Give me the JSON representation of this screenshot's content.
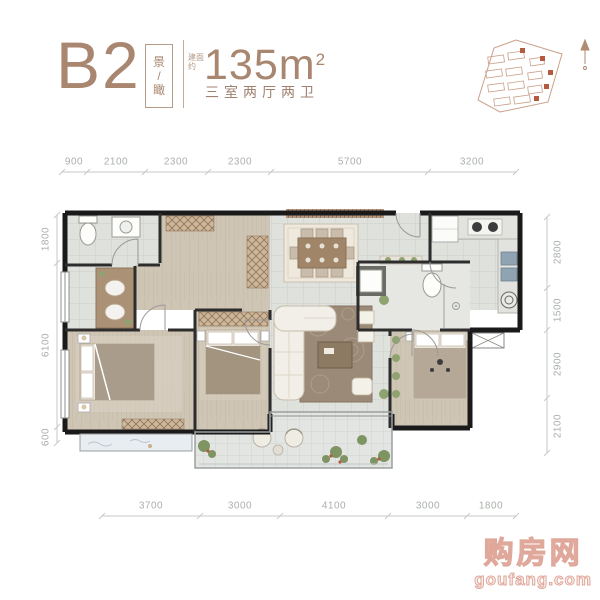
{
  "header": {
    "plan_code": "B2",
    "tag_chars": [
      "景",
      "/",
      "瞰"
    ],
    "area_prefix": "建面约",
    "area_number": "135",
    "area_unit": "m",
    "area_sup": "2",
    "layout_text": "三室两厅两卫"
  },
  "dimensions": {
    "top": [
      "900",
      "2100",
      "2300",
      "2300",
      "5700",
      "3200"
    ],
    "bottom": [
      "3700",
      "3000",
      "4100",
      "3000",
      "1800"
    ],
    "left": [
      "1800",
      "6100",
      "600"
    ],
    "right": [
      "2800",
      "1500",
      "2900",
      "2100"
    ]
  },
  "watermark": {
    "brand": "购房网",
    "domain": "goufang.com"
  },
  "colors": {
    "accent_brown": "#a8866f",
    "wall_black": "#1a1a1a",
    "wood_floor": "#cfc5b5",
    "tile_floor": "#dddfdb",
    "dimension_text": "#a9afa9",
    "site_plan_outline": "#c9a08a",
    "site_plan_marker": "#b5593f",
    "watermark_pink": "#e0a89a",
    "rug_brown": "#9b8a77",
    "bay_window_blue": "#e7edf0"
  }
}
